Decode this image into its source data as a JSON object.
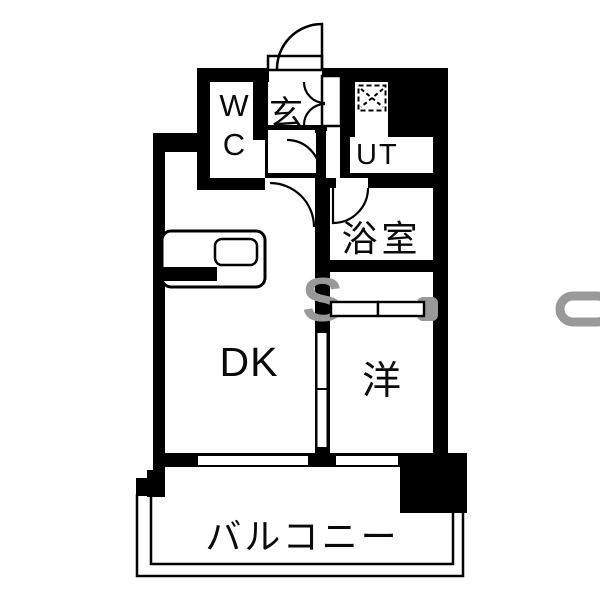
{
  "plan": {
    "rooms": {
      "wc": "WC",
      "entrance": "玄",
      "utility": "UT",
      "bathroom": "浴室",
      "dining_kitchen": "DK",
      "western_room": "洋",
      "balcony": "バルコニー"
    },
    "watermark": "S",
    "colors": {
      "wall": "#000000",
      "floor": "#ffffff",
      "watermark": "#999999"
    }
  }
}
